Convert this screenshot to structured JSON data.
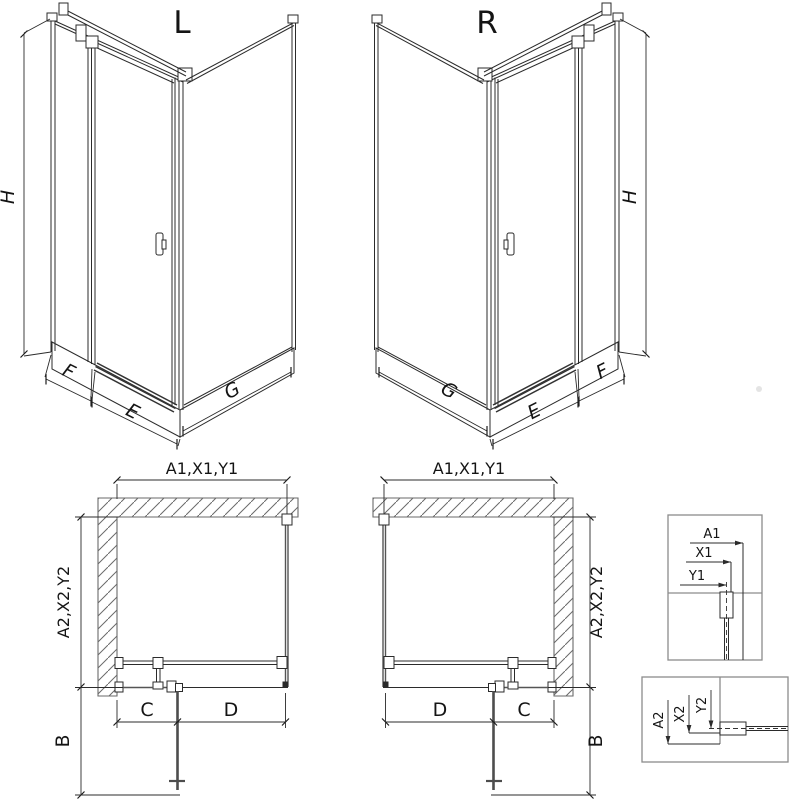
{
  "sheet": {
    "type": "shower-enclosure-technical-drawing"
  },
  "colors": {
    "line": "#2b2b2b",
    "glass": "#555555",
    "wall_hatch": "#6a6a6a",
    "detail_border": "#8c8c8c",
    "background": "#ffffff"
  },
  "iso_left": {
    "title": "L",
    "height_label": "H",
    "fixed_label": "F",
    "door_label": "E",
    "side_label": "G"
  },
  "iso_right": {
    "title": "R",
    "height_label": "H",
    "fixed_label": "F",
    "door_label": "E",
    "side_label": "G"
  },
  "plan_left": {
    "width_label": "A1,X1,Y1",
    "depth_label": "A2,X2,Y2",
    "swing_label": "B",
    "c_label": "C",
    "d_label": "D"
  },
  "plan_right": {
    "width_label": "A1,X1,Y1",
    "depth_label": "A2,X2,Y2",
    "swing_label": "B",
    "c_label": "C",
    "d_label": "D"
  },
  "detail_width": {
    "labels": [
      "A1",
      "X1",
      "Y1"
    ]
  },
  "detail_depth": {
    "labels": [
      "A2",
      "X2",
      "Y2"
    ]
  }
}
